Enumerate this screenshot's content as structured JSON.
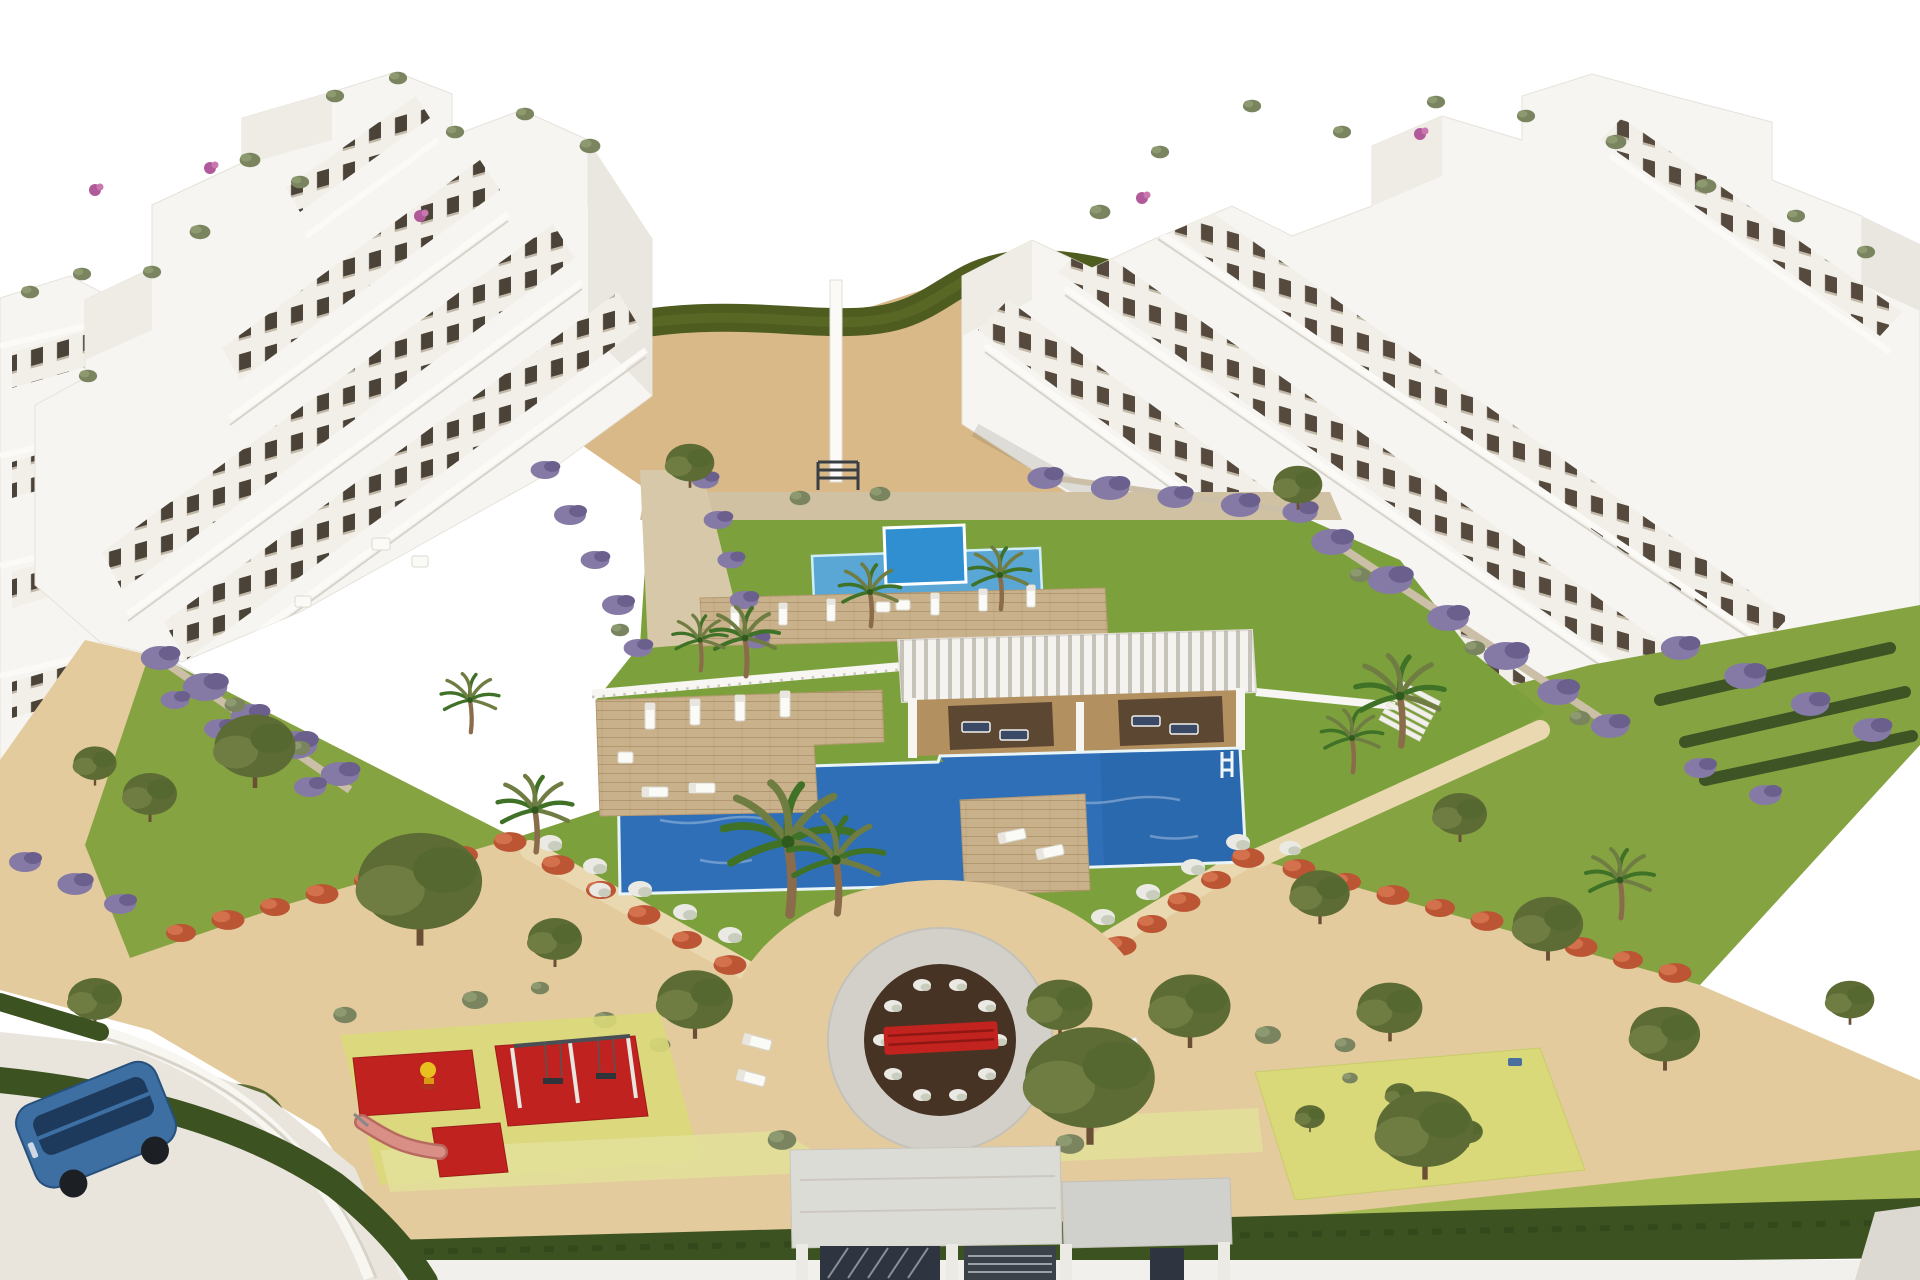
{
  "scene": {
    "title": "Aerial 3D architectural rendering of a white Mediterranean apartment complex with a landscaped pool courtyard",
    "type": "3D architectural rendering",
    "view": "aerial perspective, white sky background",
    "setting": "Two terraced white apartment blocks facing a central garden with pools, pergola, circular plaza, playground and sandy park areas"
  },
  "palette": {
    "sky": "#ffffff",
    "buildingWhite": "#f6f5f1",
    "buildingShade": "#e7e3db",
    "windowDark": "#4b4238",
    "hillSand": "#d8b987",
    "hedgeOlive": "#4e5c20",
    "lawn": "#7ca13c",
    "gardenLawn": "#86a342",
    "lawnLight": "#a8bc55",
    "sand": "#e3cb9d",
    "gravel": "#cfc1a1",
    "pathSand": "#ead9b0",
    "deckWood": "#c9b28b",
    "poolBlue": "#2f6fb8",
    "poolLight": "#5aa7d6",
    "poolBright": "#2f8fd0",
    "coping": "#e8f4f8",
    "pergolaTan": "#b3905f",
    "pergolaShade": "#5c4732",
    "fenceWhite": "#f7f6f2",
    "flowerRed": "#bb5534",
    "flowerPurple": "#857aa6",
    "flowerWhite": "#ebe9e3",
    "treeGreen": "#5d6b35",
    "treeLight": "#6f7d42",
    "palmGreen": "#3f7126",
    "shrubGray": "#7a8560",
    "matRed": "#c0231f",
    "matYellow": "#d9d97a",
    "matYellowPale": "#e3e09a",
    "plazaRing": "#d3d0ca",
    "plazaSoil": "#463324",
    "benchRed": "#c3231e",
    "roadWhite": "#f2f0ec",
    "roadAsphalt": "#e9e4dc",
    "hedgeDark": "#3c5220",
    "carBlue": "#3d6fa3",
    "canopyGray": "#dcdcd6",
    "canopyGrayDark": "#d0d0cc",
    "slideRose": "#d98f86",
    "toyYellow": "#e8c020"
  },
  "objects": {
    "buildings": {
      "left": "white terraced apartment block with balconies and rooftop plants",
      "right": "white terraced apartment block with balconies and rooftop plants",
      "far_left": "edge of adjacent white apartment block"
    },
    "water": {
      "main_pool": "large stepped blue swimming pool with white coping, ladder and wooden sun decks",
      "kids_pool": "children's pool with raised bright-blue plunge square"
    },
    "structures": {
      "pergola": "white slat-roof pergola with tan cabana bays and day beds",
      "fence": "white pool fence",
      "entrance": "gated entrance with flat gray canopy and dark slatted gates",
      "plaza": "circular plaza with dark planting bed, white flower shrubs and red bench",
      "stairs": "garden stairs on the right side",
      "hill": "sandy slope with olive hedge band and white gate pillar"
    },
    "recreation": {
      "playground": "children's playground with red safety mats, swing set, pink slide and yellow spring rider",
      "exercise_area": "yellow-green outdoor exercise mat with topiary sculptures"
    },
    "vegetation": {
      "palms": "palm trees around the pools",
      "trees": "olive trees in the sandy park areas",
      "purple_hedges": "purple flowering hedges at the building bases",
      "red_hedges": "red flowering hedges along the diagonal paths",
      "white_shrubs": "white flowering shrubs along the lawn edges",
      "perimeter_hedge": "dark green perimeter hedges along road and bottom edge"
    },
    "vehicle": {
      "car": "blue car parked on the street at bottom-left"
    }
  }
}
